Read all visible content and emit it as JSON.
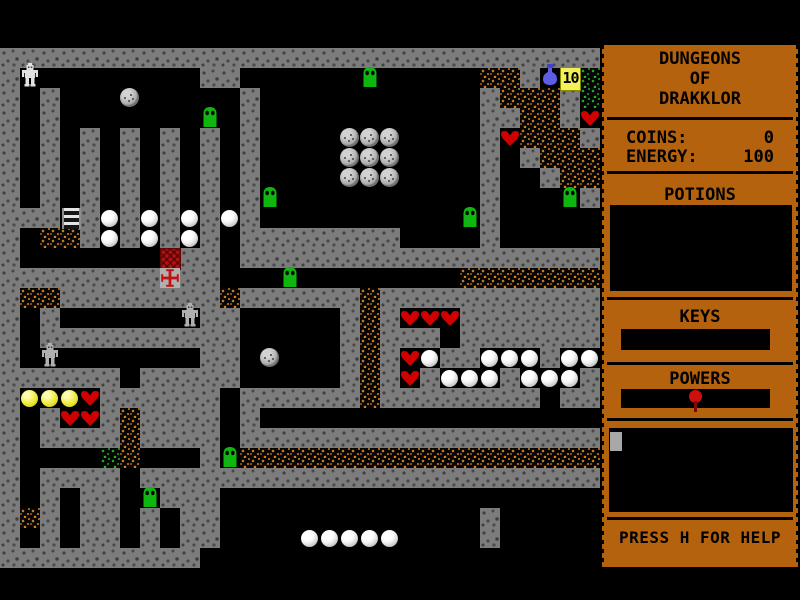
{
  "game": {
    "title_lines": [
      "DUNGEONS",
      "OF",
      "DRAKKLOR"
    ],
    "stats": [
      {
        "label": "COINS:",
        "value": "0"
      },
      {
        "label": "ENERGY:",
        "value": "100"
      }
    ],
    "sections": {
      "potions": "POTIONS",
      "keys": "KEYS",
      "powers": "POWERS"
    },
    "help_text": "PRESS H FOR HELP",
    "counter_value": "10"
  },
  "map": {
    "tile_size": 20,
    "origin_y": 8,
    "cols": 30,
    "rows": [
      "..............................",
      "..............................",
      "##############################",
      "#P........##......s.....dd#FTg",
      "#.#...b.....#...........#ddd#g",
      "#.#.......s.#...........##dd#h",
      "#.#.#.#.#.#.#....bbb....#hddd#",
      "#.#.#.#.#.#.#....bbb....#.#ddd",
      "#.#.#.#.#.#.#....bbb....#..#dd",
      "#.#.#.#.#.#.#s..........#...s#",
      "###L#p#p#p#p#..........s#.....",
      "#.dd#p#p#p#.########....#.....",
      "#.......C##.##################",
      "########X##...s........ddddddd",
      "#dd########d######d###########",
      "#.#......S##.....#d#hhh#######",
      "#.##########.....#d###.#######",
      "#.S.......##.b...#d#hp##ppp#pp",
      "######.#####.....#d#h#ppp#ppp#",
      "#yyyh######.######d########.##",
      "#.#hh#d####.#.................",
      "#.####d####.##################",
      "#....gd...#sdddddddddddddddddd",
      "#.####.#######################",
      "#.#.##.s###...................",
      "#d#.##.#.##.............#.....",
      "#.#.##.#.##....ppppp....#.....",
      "##########...................."
    ],
    "legend": {
      "#": "wall",
      ".": "floor",
      "d": "dirt",
      "g": "green-dirt",
      "p": "pearl",
      "y": "yellow-ball",
      "b": "boulder",
      "h": "heart",
      "s": "slime",
      "P": "player",
      "S": "statue",
      "L": "ladder",
      "C": "chest",
      "X": "red-cross",
      "F": "blue-flask",
      "T": "counter-10"
    }
  },
  "colors": {
    "sidebar_bg": "#b4620e",
    "wall": "#7c7c7c",
    "dirt_fleck": "#c87a1e",
    "green_fleck": "#22a822",
    "slime": "#0fb60f",
    "heart": "#d00000",
    "pearl": "#ffffff",
    "yellow_ball": "#e8e432",
    "boulder": "#b2b2b2",
    "chest": "#b41212",
    "cross": "#c41010",
    "flask": "#5d5de6",
    "counter_bg": "#f2f258",
    "player": "#e2e2e2",
    "statue": "#b0b0b0"
  }
}
